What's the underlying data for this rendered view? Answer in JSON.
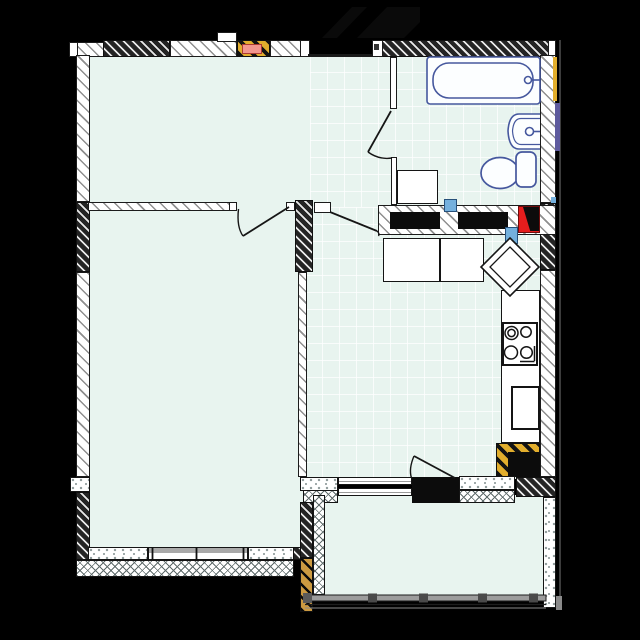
{
  "app": {
    "type": "architectural-floor-plan",
    "description": "One-bedroom apartment floor plan with living room, bedroom, hallway, bathroom, kitchen and balcony",
    "text_labels": []
  },
  "palette": {
    "background": "#000000",
    "floor": "#e8f4ef",
    "tileline": "rgba(255,255,255,0.75)",
    "wall": "#1b1b1b",
    "hatchline": "#8f8f8f",
    "crossline": "#5f6b6b",
    "speckle": "#8f9b9b",
    "yellow": "#e2ae2d",
    "tan": "#cc9a41",
    "pinkfill": "#f2958d",
    "pinkstroke": "#ad3a31",
    "red": "#e51d1d",
    "blue": "#74b0dd",
    "purple": "#5e5a9d",
    "fixture": "#46589e",
    "railing": "#9c9c9c",
    "blackcore": "#0c0c0c"
  },
  "rooms": [
    {
      "id": "living-room",
      "floor": "plain",
      "position": "top-left"
    },
    {
      "id": "hallway",
      "floor": "tile",
      "position": "top-center",
      "features": [
        "entrance-opening",
        "entrance-arrow-marker"
      ]
    },
    {
      "id": "bathroom",
      "floor": "tile",
      "position": "top-right",
      "fixtures": [
        "bathtub",
        "wash-basin",
        "toilet",
        "washing-machine"
      ]
    },
    {
      "id": "kitchen",
      "floor": "tile",
      "position": "middle-right",
      "fixtures": [
        "counter-cabinet-1",
        "counter-cabinet-2",
        "corner-sink-diamond",
        "stove-4-burner",
        "oven",
        "vent-shaft"
      ]
    },
    {
      "id": "bedroom",
      "floor": "plain",
      "position": "bottom-left",
      "features": [
        "window"
      ]
    },
    {
      "id": "balcony",
      "floor": "plain",
      "position": "bottom-right",
      "features": [
        "glazed-railing",
        "balcony-door"
      ]
    }
  ],
  "markers": {
    "vent_duct_pink": "#f2958d",
    "vent_blocks_yellow_black": 2,
    "plumbing_risers_blue": 2,
    "fire_or_chute_block_red": "#e51d1d",
    "gas_pipe_strip_yellow": "#e2ae2d",
    "water_pipe_strip_purple": "#5e5a9d",
    "doors": [
      "bedroom-door",
      "bathroom-door",
      "kitchen-door",
      "balcony-door"
    ],
    "windows": [
      "bedroom-south-window",
      "kitchen-to-balcony-window"
    ]
  }
}
